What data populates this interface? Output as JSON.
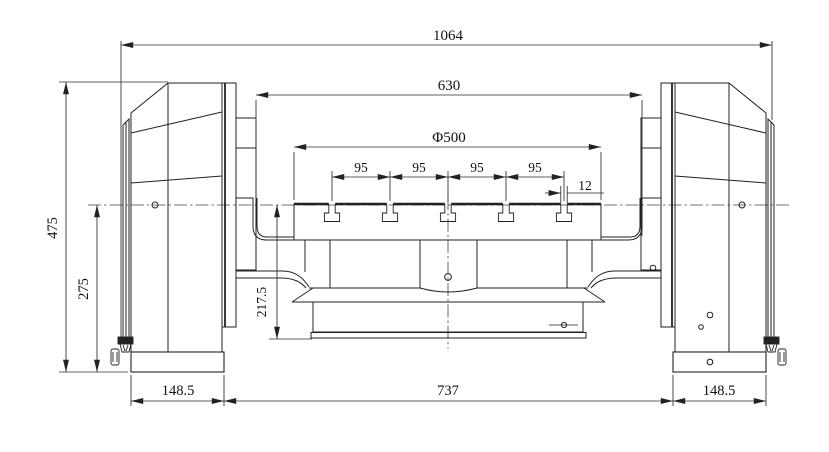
{
  "drawing": {
    "type": "engineering-dimension-drawing",
    "view": "front view of trunnion rotary table",
    "line_color": "#222222",
    "background": "#ffffff",
    "dimensions": {
      "overall_width": "1064",
      "inner_frame_width": "630",
      "table_diameter": "Φ500",
      "slot_pitches": [
        "95",
        "95",
        "95",
        "95"
      ],
      "t_slot_width": "12",
      "overall_height": "475",
      "axis_height": "275",
      "table_unit_height": "217.5",
      "left_base_width": "148.5",
      "base_span": "737",
      "right_base_width": "148.5"
    }
  }
}
